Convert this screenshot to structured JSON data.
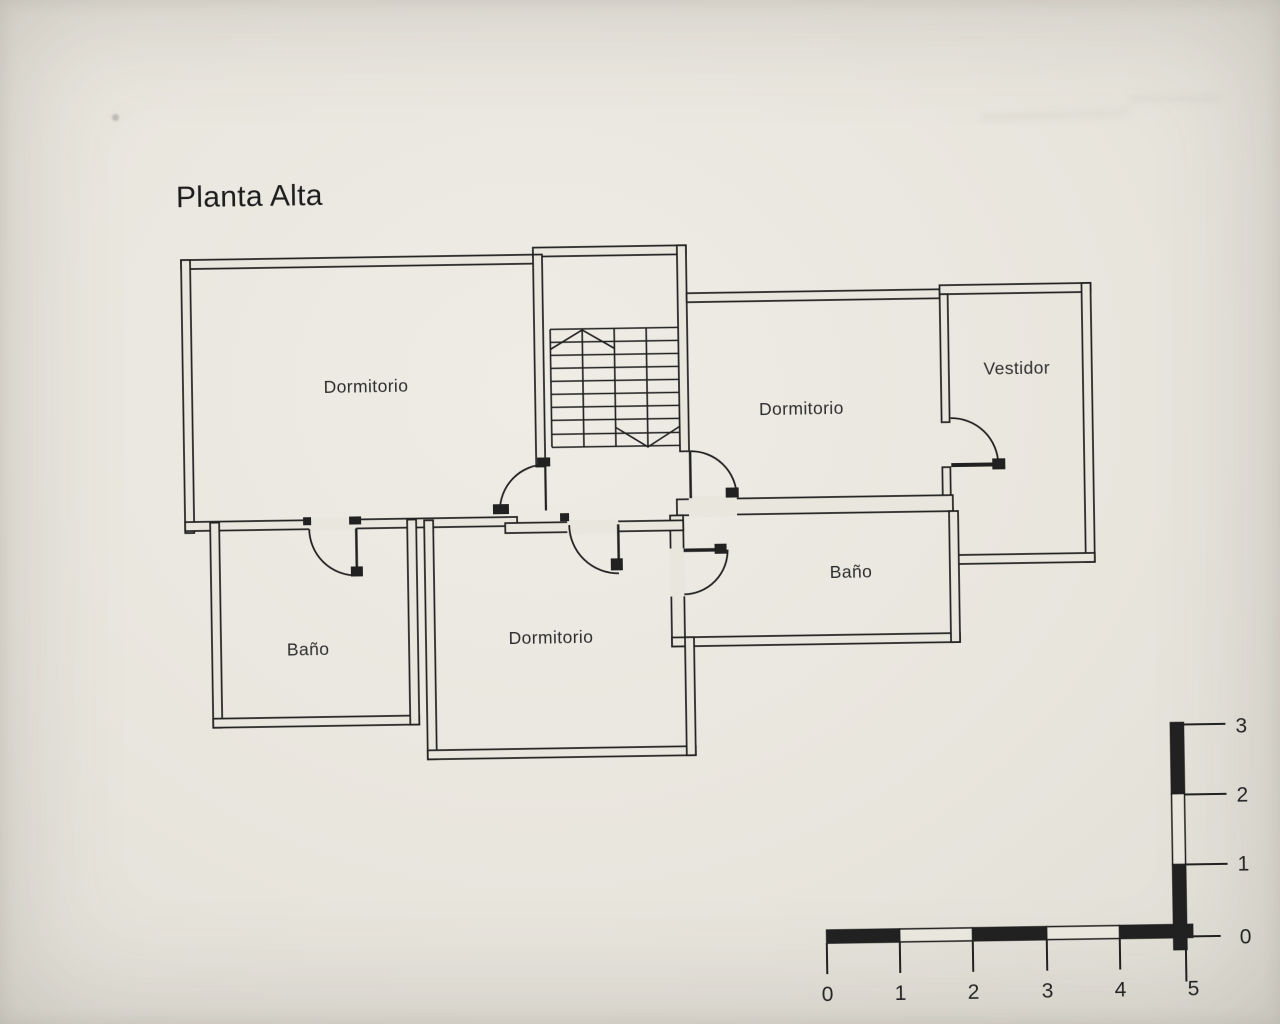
{
  "colors": {
    "paper": "#e9e6de",
    "ink": "#212121"
  },
  "title": "Planta Alta",
  "rooms": [
    {
      "id": "dormitorio-top-left",
      "label": "Dormitorio"
    },
    {
      "id": "dormitorio-top-right",
      "label": "Dormitorio"
    },
    {
      "id": "vestidor",
      "label": "Vestidor"
    },
    {
      "id": "bano-right",
      "label": "Baño"
    },
    {
      "id": "bano-left",
      "label": "Baño"
    },
    {
      "id": "dormitorio-bottom",
      "label": "Dormitorio"
    }
  ],
  "scale_bar": {
    "horizontal_labels": [
      "0",
      "1",
      "2",
      "3",
      "4",
      "5"
    ],
    "vertical_labels": [
      "3",
      "2",
      "1",
      "0"
    ]
  }
}
